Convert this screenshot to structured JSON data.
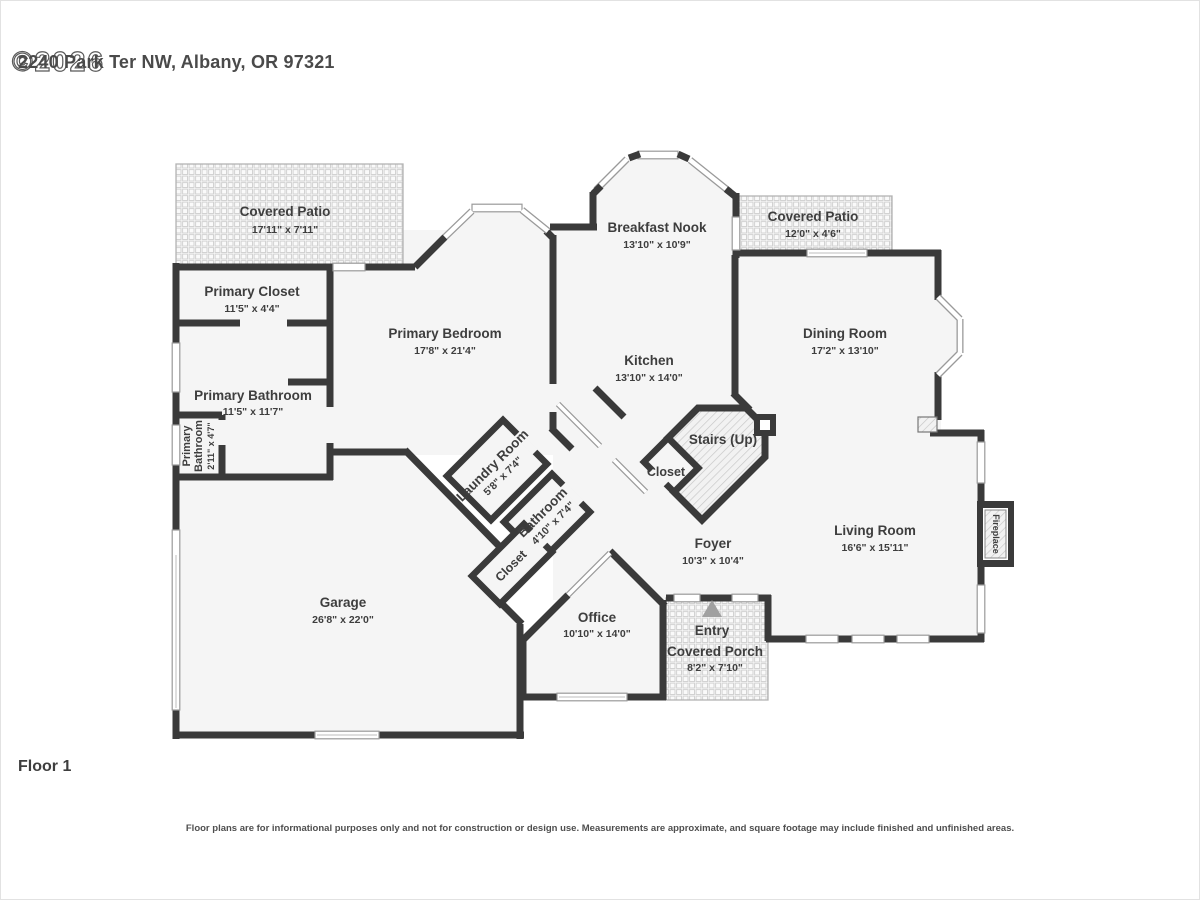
{
  "header": {
    "address": "2240 Park Ter NW, Albany, OR 97321",
    "watermark": "©2026"
  },
  "floor_label": "Floor 1",
  "disclaimer": "Floor plans are for informational purposes only and not for construction or design use. Measurements are approximate, and square footage may include finished and unfinished areas.",
  "rooms": {
    "covered_patio_left": {
      "name": "Covered Patio",
      "dims": "17'11\" x 7'11\""
    },
    "primary_closet": {
      "name": "Primary Closet",
      "dims": "11'5\" x 4'4\""
    },
    "primary_bathroom": {
      "name": "Primary Bathroom",
      "dims": "11'5\" x 11'7\""
    },
    "primary_wc": {
      "name_line1": "Primary",
      "name_line2": "Bathroom",
      "dims": "2'11\" x 4'7\""
    },
    "primary_bedroom": {
      "name": "Primary Bedroom",
      "dims": "17'8\" x 21'4\""
    },
    "breakfast_nook": {
      "name": "Breakfast Nook",
      "dims": "13'10\" x 10'9\""
    },
    "covered_patio_right": {
      "name": "Covered Patio",
      "dims": "12'0\" x 4'6\""
    },
    "dining_room": {
      "name": "Dining Room",
      "dims": "17'2\" x 13'10\""
    },
    "kitchen": {
      "name": "Kitchen",
      "dims": "13'10\" x 14'0\""
    },
    "stairs": {
      "name": "Stairs (Up)"
    },
    "stairs_closet": {
      "name": "Closet"
    },
    "laundry_room": {
      "name": "Laundry Room",
      "dims": "5'8\" x 7'4\""
    },
    "bathroom": {
      "name": "Bathroom",
      "dims": "4'10\" x 7'4\""
    },
    "hall_closet": {
      "name": "Closet"
    },
    "foyer": {
      "name": "Foyer",
      "dims": "10'3\" x 10'4\""
    },
    "living_room": {
      "name": "Living Room",
      "dims": "16'6\" x 15'11\""
    },
    "fireplace": {
      "name": "Fireplace"
    },
    "garage": {
      "name": "Garage",
      "dims": "26'8\" x 22'0\""
    },
    "office": {
      "name": "Office",
      "dims": "10'10\" x 14'0\""
    },
    "entry": {
      "name": "Entry"
    },
    "covered_porch": {
      "name": "Covered Porch",
      "dims": "8'2\" x 7'10\""
    }
  },
  "colors": {
    "wall": "#3a3a3a",
    "room_fill": "#f5f5f5",
    "accent_text": "#3e3e3e"
  }
}
